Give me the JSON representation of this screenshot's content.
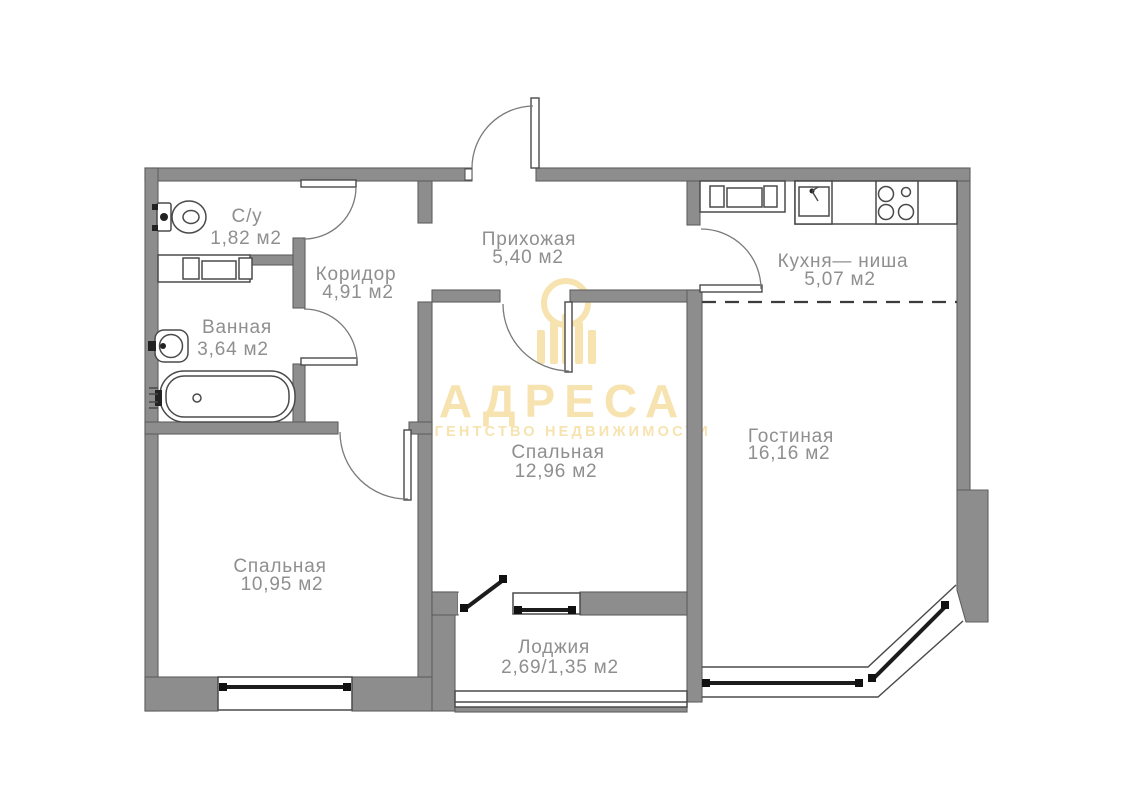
{
  "watermark": {
    "brand": "АДРЕСА",
    "subtitle": "АГЕНТСТВО НЕДВИЖИМОСТИ",
    "logo_icon": "building-columns-icon"
  },
  "colors": {
    "wall": "#8d8d8d",
    "wall_outline": "#5f5f5f",
    "line": "#4a4a4a",
    "glazing": "#1c1c1c",
    "label_text": "#8f8f8f",
    "watermark_gold": "#f6e3b0"
  },
  "rooms": [
    {
      "id": "su",
      "name": "С/у",
      "area": "1,82 м2"
    },
    {
      "id": "koridor",
      "name": "Коридор",
      "area": "4,91 м2"
    },
    {
      "id": "vannaya",
      "name": "Ванная",
      "area": "3,64 м2"
    },
    {
      "id": "prihozhaya",
      "name": "Прихожая",
      "area": "5,40 м2"
    },
    {
      "id": "kuhnya",
      "name": "Кухня— ниша",
      "area": "5,07 м2"
    },
    {
      "id": "gostinaya",
      "name": "Гостиная",
      "area": "16,16 м2"
    },
    {
      "id": "spalnaya-1",
      "name": "Спальная",
      "area": "12,96 м2"
    },
    {
      "id": "spalnaya-2",
      "name": "Спальная",
      "area": "10,95 м2"
    },
    {
      "id": "lodzhiya",
      "name": "Лоджия",
      "area": "2,69/1,35 м2"
    }
  ]
}
